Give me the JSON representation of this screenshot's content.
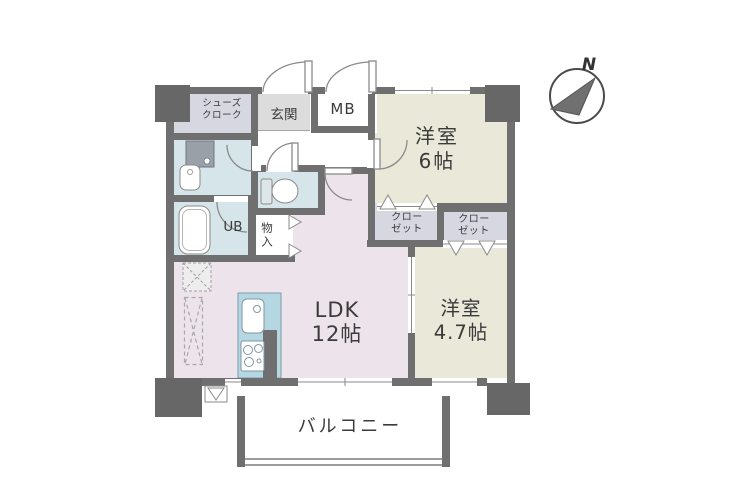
{
  "compass": {
    "label": "N"
  },
  "rooms": {
    "shoes_closet": {
      "line1": "シューズ",
      "line2": "クローク"
    },
    "entrance": {
      "label": "玄関"
    },
    "meter_box": {
      "label": "MB"
    },
    "western_room_6": {
      "line1": "洋室",
      "line2": "6帖"
    },
    "closet_left": {
      "line1": "クロー",
      "line2": "ゼット"
    },
    "closet_right": {
      "line1": "クロー",
      "line2": "ゼット"
    },
    "unit_bath": {
      "label": "UB"
    },
    "storage": {
      "label": "物入"
    },
    "ldk": {
      "line1": "LDK",
      "line2": "12帖"
    },
    "western_room_47": {
      "line1": "洋室",
      "line2": "4.7帖"
    },
    "balcony": {
      "label": "バルコニー"
    }
  },
  "colors": {
    "wall": "#6f6f6f",
    "pillar": "#676767",
    "western_room_fill": "#eae8d8",
    "ldk_fill": "#ece4ea",
    "wet_area_fill": "#d6e5ea",
    "kitchen_fill": "#b4d7e2",
    "closet_fill": "#d7d7e2",
    "entrance_fill": "#dcdcdc",
    "balcony_rail": "#9c9c9c",
    "text": "#3b3b3b"
  }
}
